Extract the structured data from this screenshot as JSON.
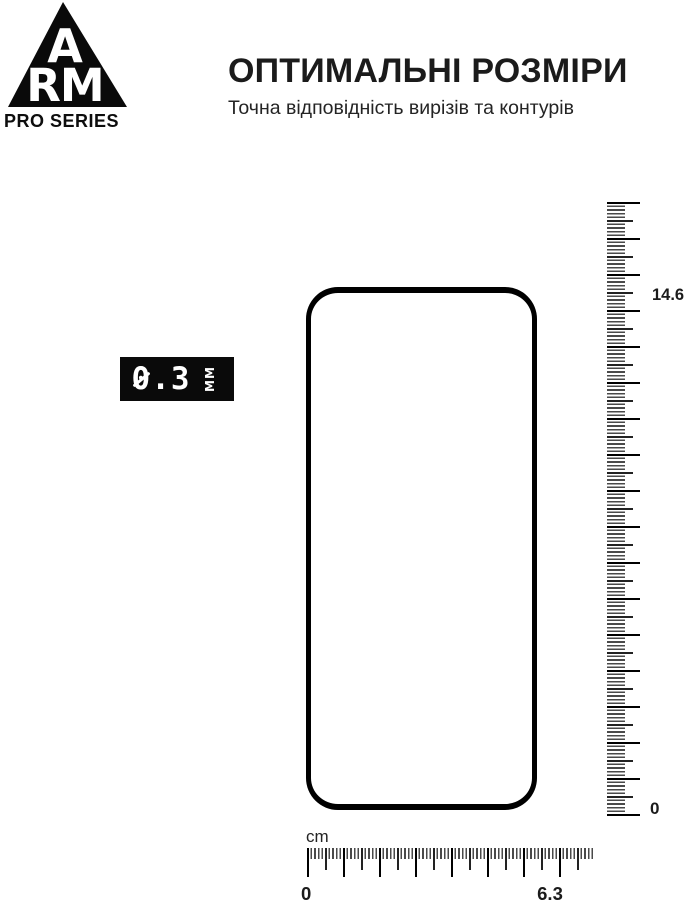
{
  "brand": {
    "letter_top": "A",
    "letters_bottom": "RM",
    "series": "PRO SERIES"
  },
  "header": {
    "title": "ОПТИМАЛЬНІ РОЗМІРИ",
    "subtitle": "Точна відповідність вирізів та контурів"
  },
  "thickness_badge": {
    "value": "0.3",
    "unit": "ММ"
  },
  "rulers": {
    "vertical": {
      "max_label": "14.6",
      "min_label": "0"
    },
    "horizontal": {
      "unit_label": "cm",
      "min_label": "0",
      "max_label": "6.3"
    }
  },
  "colors": {
    "ink": "#111111",
    "background": "#ffffff"
  }
}
